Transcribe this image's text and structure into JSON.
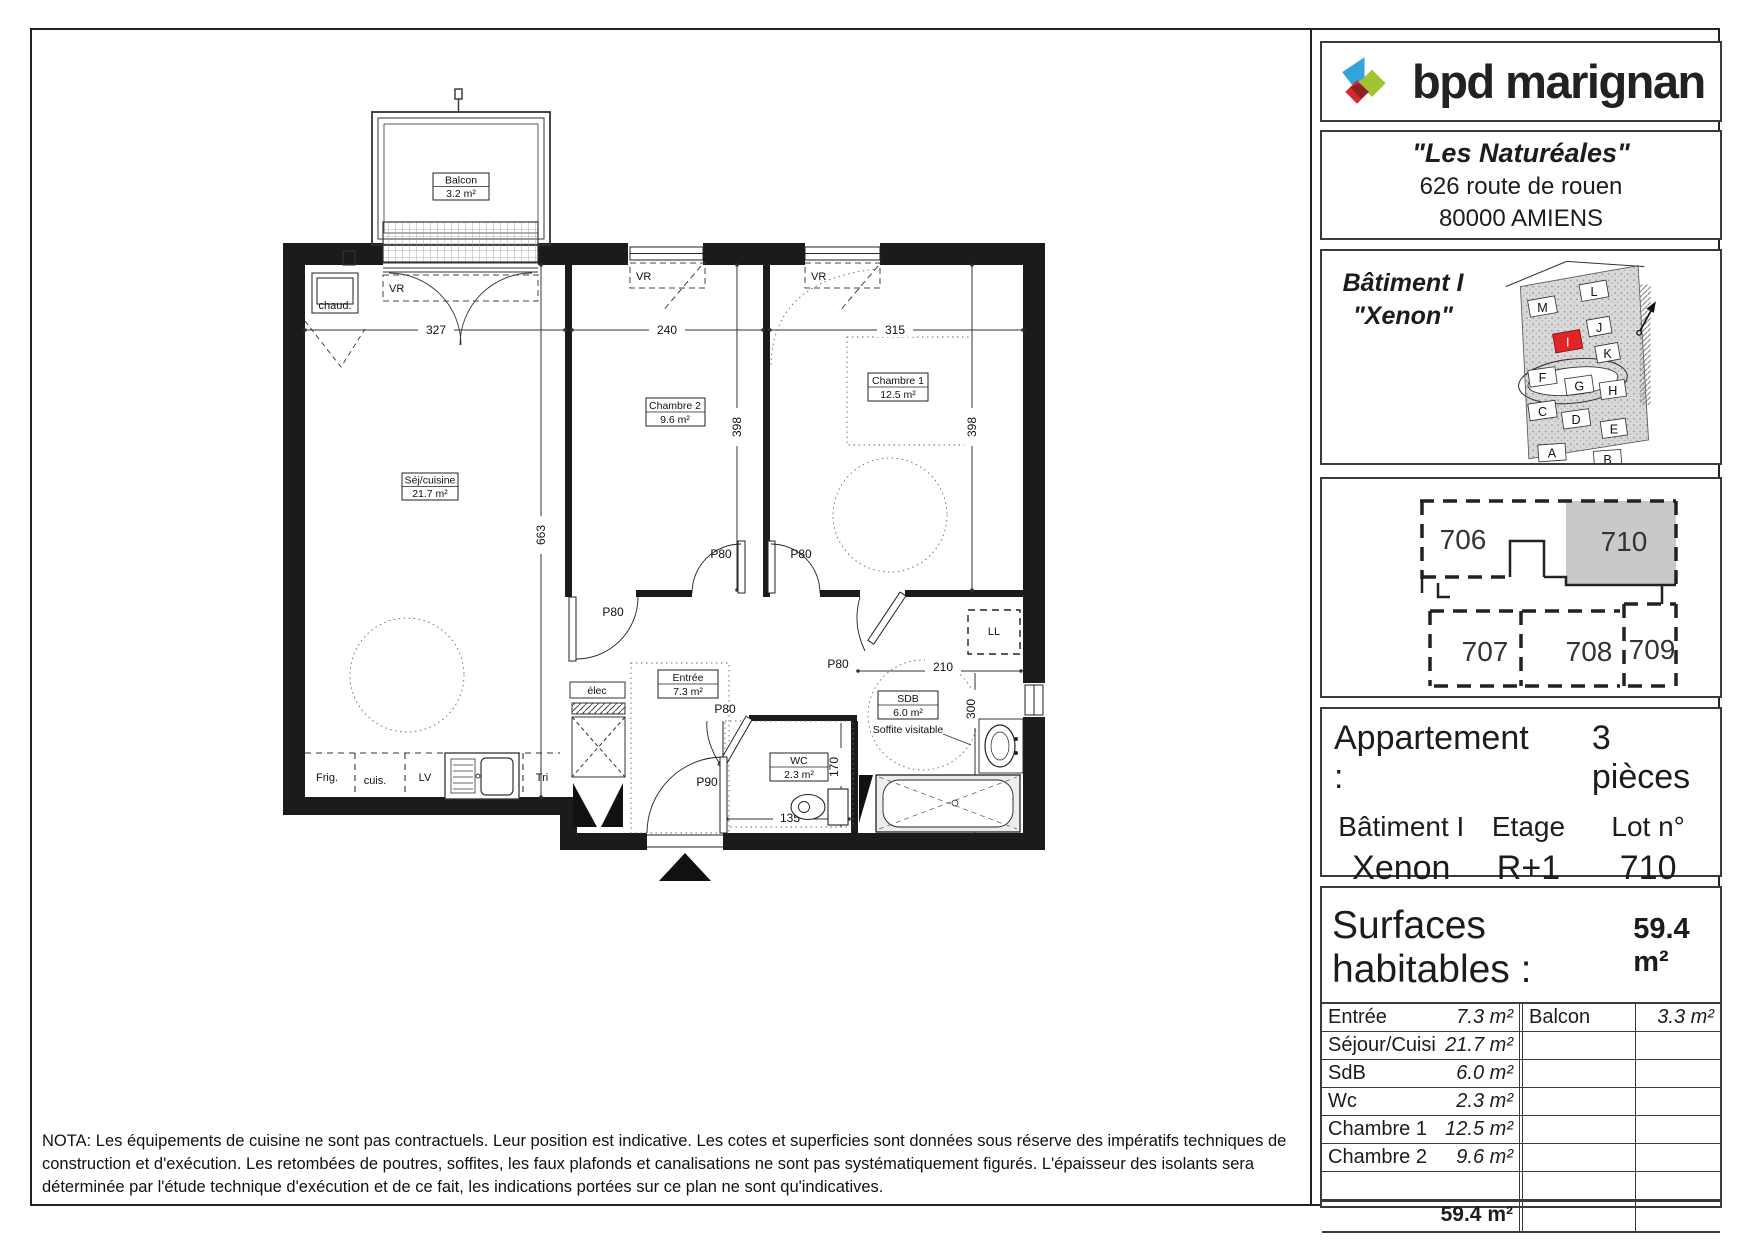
{
  "branding": {
    "logo_text": "bpd marignan",
    "colors": {
      "blue": "#33a3dc",
      "green": "#9fc531",
      "red": "#d7282f",
      "overlap": "#8c2025",
      "unit_gray": "#c9c9c9"
    }
  },
  "project": {
    "name": "\"Les Naturéales\"",
    "address1": "626 route de rouen",
    "address2": "80000  AMIENS"
  },
  "building": {
    "line1": "Bâtiment I",
    "line2": "\"Xenon\"",
    "site_blocks": [
      "M",
      "L",
      "J",
      "K",
      "I",
      "F",
      "G",
      "H",
      "C",
      "D",
      "E",
      "A",
      "B"
    ]
  },
  "key_plan": {
    "units": [
      "706",
      "710",
      "707",
      "708",
      "709"
    ]
  },
  "apartment": {
    "type_label": "Appartement :",
    "type_value": "3 pièces",
    "building_label": "Bâtiment I",
    "building_value": "Xenon",
    "floor_label": "Etage",
    "floor_value": "R+1",
    "lot_label": "Lot n°",
    "lot_value": "710"
  },
  "surfaces": {
    "title": "Surfaces habitables :",
    "total_header": "59.4 m²",
    "rows": [
      {
        "l": "Entrée",
        "v": "7.3 m²",
        "rl": "Balcon",
        "rv": "3.3 m²"
      },
      {
        "l": "Séjour/Cuisine",
        "v": "21.7 m²",
        "rl": "",
        "rv": ""
      },
      {
        "l": "SdB",
        "v": "6.0 m²",
        "rl": "",
        "rv": ""
      },
      {
        "l": "Wc",
        "v": "2.3 m²",
        "rl": "",
        "rv": ""
      },
      {
        "l": "Chambre 1",
        "v": "12.5 m²",
        "rl": "",
        "rv": ""
      },
      {
        "l": "Chambre 2",
        "v": "9.6 m²",
        "rl": "",
        "rv": ""
      },
      {
        "l": "",
        "v": "",
        "rl": "",
        "rv": ""
      }
    ],
    "total_value": "59.4 m²",
    "date": "Date : 10 mars 2016"
  },
  "nota": "NOTA: Les équipements de cuisine ne sont pas contractuels. Leur position est indicative. Les cotes et superficies sont données sous réserve des impératifs techniques de construction et d'exécution. Les retombées de poutres, soffites, les faux plafonds et canalisations ne sont pas systématiquement figurés. L'épaisseur des isolants sera déterminée par l'étude technique d'exécution et de ce fait, les indications portées sur ce plan ne sont qu'indicatives.",
  "plan": {
    "rooms": {
      "balcon": {
        "name": "Balcon",
        "area": "3.2 m²"
      },
      "sej": {
        "name": "Séj/cuisine",
        "area": "21.7 m²"
      },
      "ch2": {
        "name": "Chambre 2",
        "area": "9.6 m²"
      },
      "ch1": {
        "name": "Chambre 1",
        "area": "12.5 m²"
      },
      "entree": {
        "name": "Entrée",
        "area": "7.3 m²"
      },
      "sdb": {
        "name": "SDB",
        "area": "6.0 m²",
        "note": "Soffite visitable"
      },
      "wc": {
        "name": "WC",
        "area": "2.3 m²"
      }
    },
    "dims": {
      "w_sej": "327",
      "w_ch2": "240",
      "w_ch1": "315",
      "d_ch": "398",
      "d_sej": "663",
      "w_sdb": "210",
      "d_sdb": "300",
      "d_wc": "170",
      "w_wc": "135"
    },
    "doors": {
      "std": "P80",
      "entry": "P90"
    },
    "fixtures": {
      "chaud": "chaud.",
      "vr": "VR",
      "elec": "élec",
      "frig": "Frig.",
      "cuis": "cuis.",
      "lv": "LV",
      "tri": "Tri",
      "ll": "LL"
    }
  }
}
